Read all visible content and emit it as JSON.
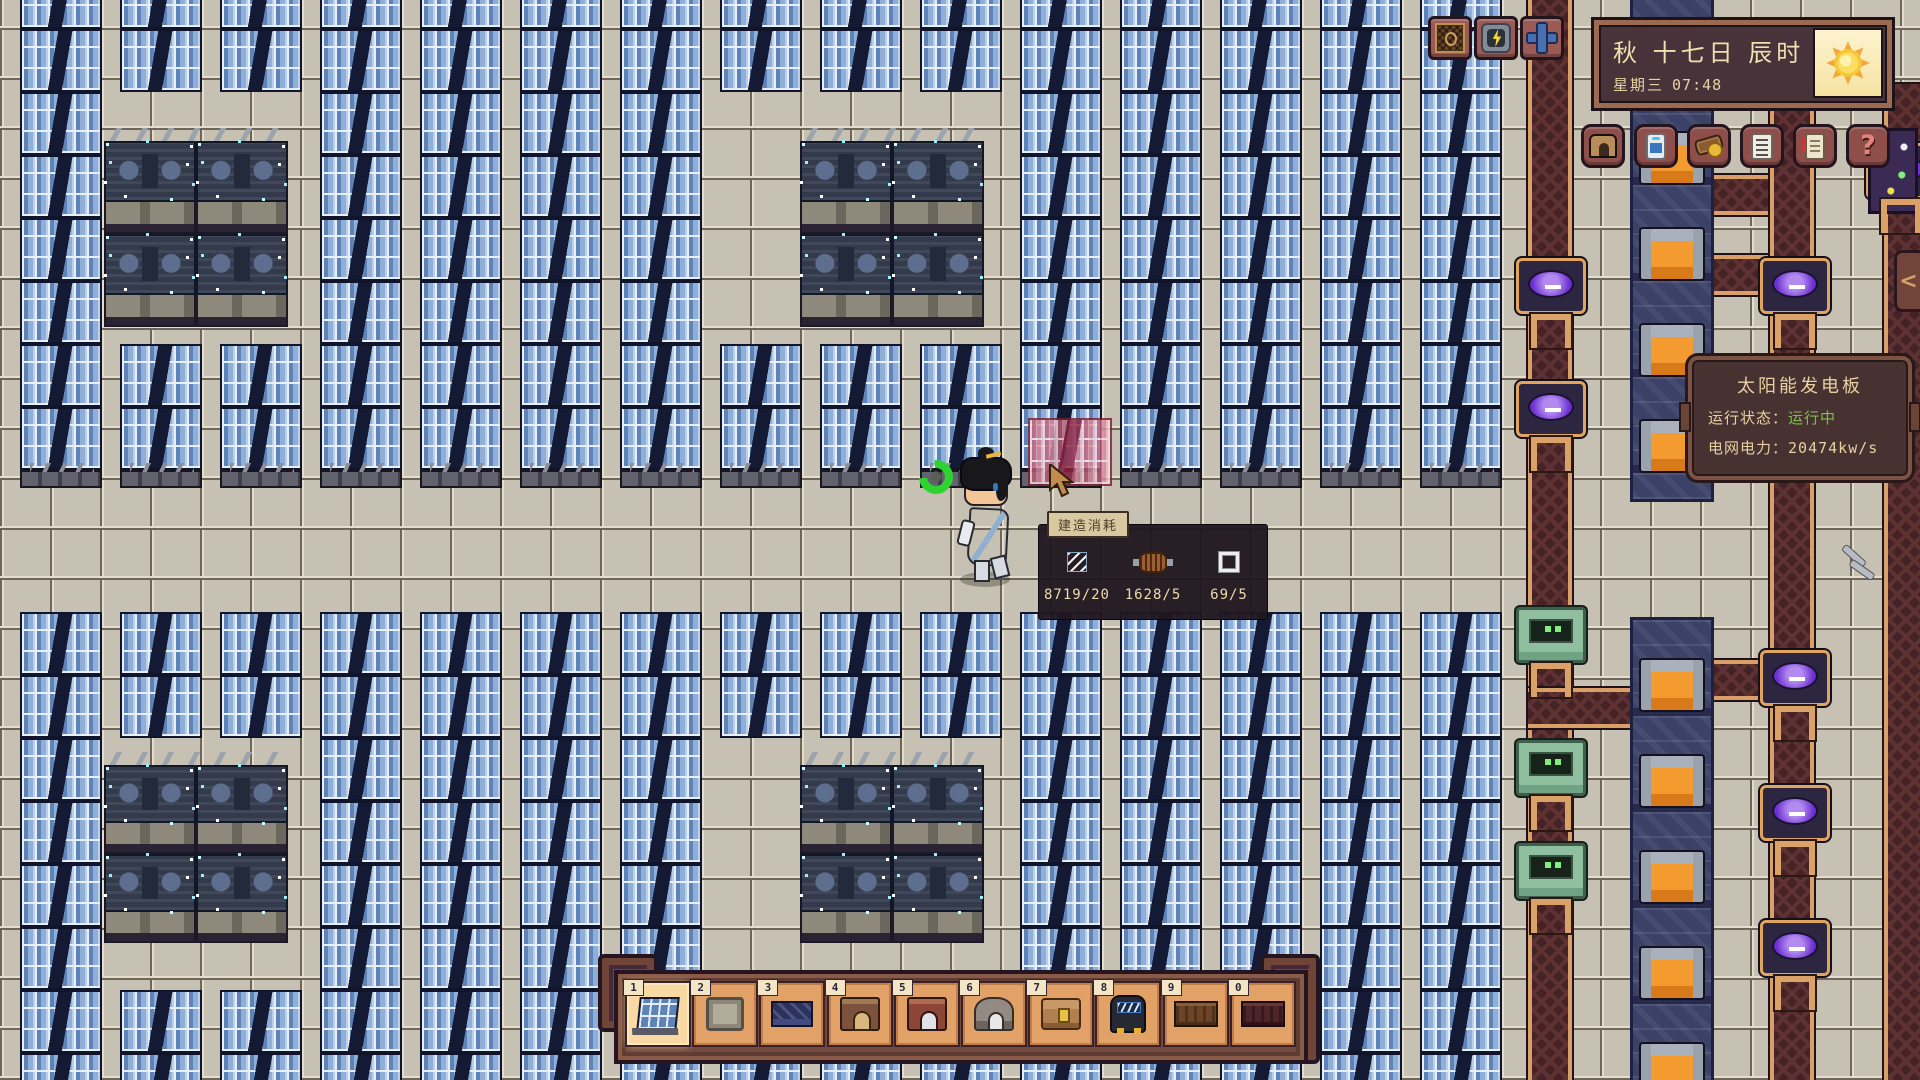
{
  "hud": {
    "clock": {
      "date": "秋 十七日 辰时",
      "weekday": "星期三",
      "time": "07:48",
      "weather_icon": "sun-icon"
    },
    "map_buttons": [
      {
        "icon": "hatch-icon"
      },
      {
        "icon": "power-icon"
      },
      {
        "icon": "pipe-valve-icon"
      }
    ],
    "menu_buttons": [
      {
        "icon": "home-icon"
      },
      {
        "icon": "device-icon"
      },
      {
        "icon": "resources-icon"
      },
      {
        "icon": "list-icon"
      },
      {
        "icon": "quest-icon"
      },
      {
        "icon": "help-icon",
        "glyph": "?"
      }
    ],
    "collapse_tab": {
      "glyph": "<"
    }
  },
  "solar_tooltip": {
    "title": "太阳能发电板",
    "status_label": "运行状态：",
    "status_value": "运行中",
    "status_color": "#7cbf4e",
    "power_label": "电网电力：",
    "power_value": "20474kw/s"
  },
  "build_tooltip": {
    "title": "建造消耗",
    "items": [
      {
        "icon": "glass-icon",
        "count": "8719/20"
      },
      {
        "icon": "coil-icon",
        "count": "1628/5"
      },
      {
        "icon": "frame-icon",
        "count": "69/5"
      }
    ]
  },
  "hotbar": {
    "selected_index": 0,
    "slots": [
      {
        "key": "1",
        "item": "solar-panel"
      },
      {
        "key": "2",
        "item": "stone-floor"
      },
      {
        "key": "3",
        "item": "blue-mat"
      },
      {
        "key": "4",
        "item": "furnace"
      },
      {
        "key": "5",
        "item": "red-furnace"
      },
      {
        "key": "6",
        "item": "dome-machine"
      },
      {
        "key": "7",
        "item": "wooden-chest"
      },
      {
        "key": "8",
        "item": "generator"
      },
      {
        "key": "9",
        "item": "belt-brown"
      },
      {
        "key": "0",
        "item": "belt-dark"
      }
    ]
  },
  "colors": {
    "status_green": "#7cbf4e",
    "panel_blue": "#6e94c8",
    "ui_cream": "#ecd9a8"
  }
}
